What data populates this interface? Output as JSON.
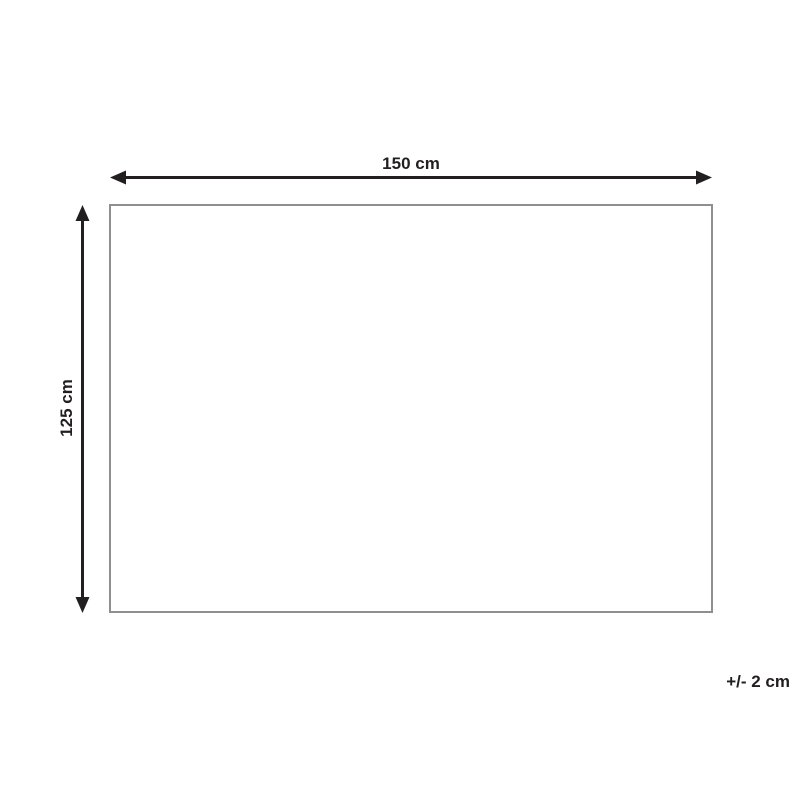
{
  "diagram": {
    "title": "product-dimension-diagram",
    "width_label": "150 cm",
    "height_label": "125 cm",
    "tolerance_label": "+/- 2 cm",
    "width_cm": 150,
    "height_cm": 125,
    "tolerance_cm": 2,
    "colors": {
      "arrow": "#231f20",
      "rect_border": "#8f8f92",
      "background": "#ffffff",
      "text": "#231f20"
    }
  }
}
